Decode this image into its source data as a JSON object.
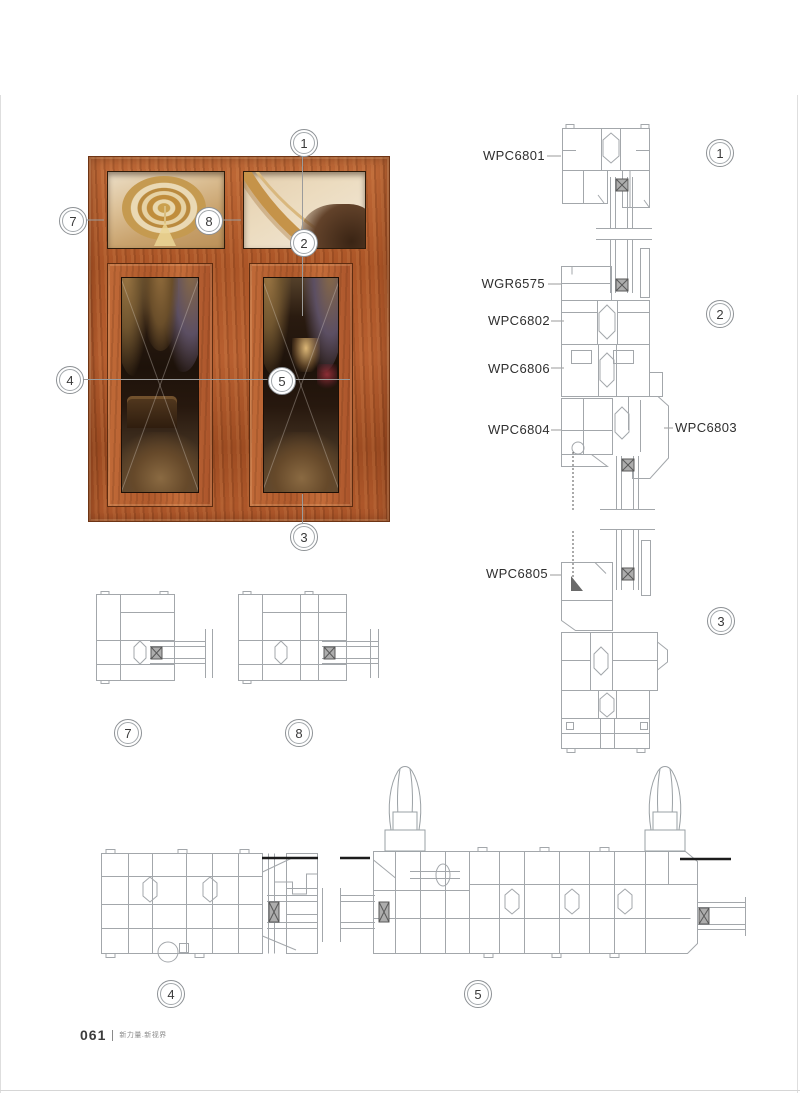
{
  "footer": {
    "page_number": "061",
    "slogan": "新力量.新视界"
  },
  "window_photo": {
    "callouts": [
      "1",
      "7",
      "8",
      "2",
      "4",
      "5",
      "3"
    ]
  },
  "vertical_section": {
    "labels": [
      "WPC6801",
      "WGR6575",
      "WPC6802",
      "WPC6806",
      "WPC6804",
      "WPC6803",
      "WPC6805"
    ],
    "callouts": [
      "1",
      "2",
      "3"
    ]
  },
  "horizontal_sections": {
    "callouts": [
      "7",
      "8",
      "4",
      "5"
    ]
  },
  "colors": {
    "wood": "#b05a2c",
    "drawing_line": "#a3a7ab",
    "label_text": "#2f2f2f",
    "ceiling_glass": "#d8bd93",
    "dark_glass": "#241710"
  }
}
